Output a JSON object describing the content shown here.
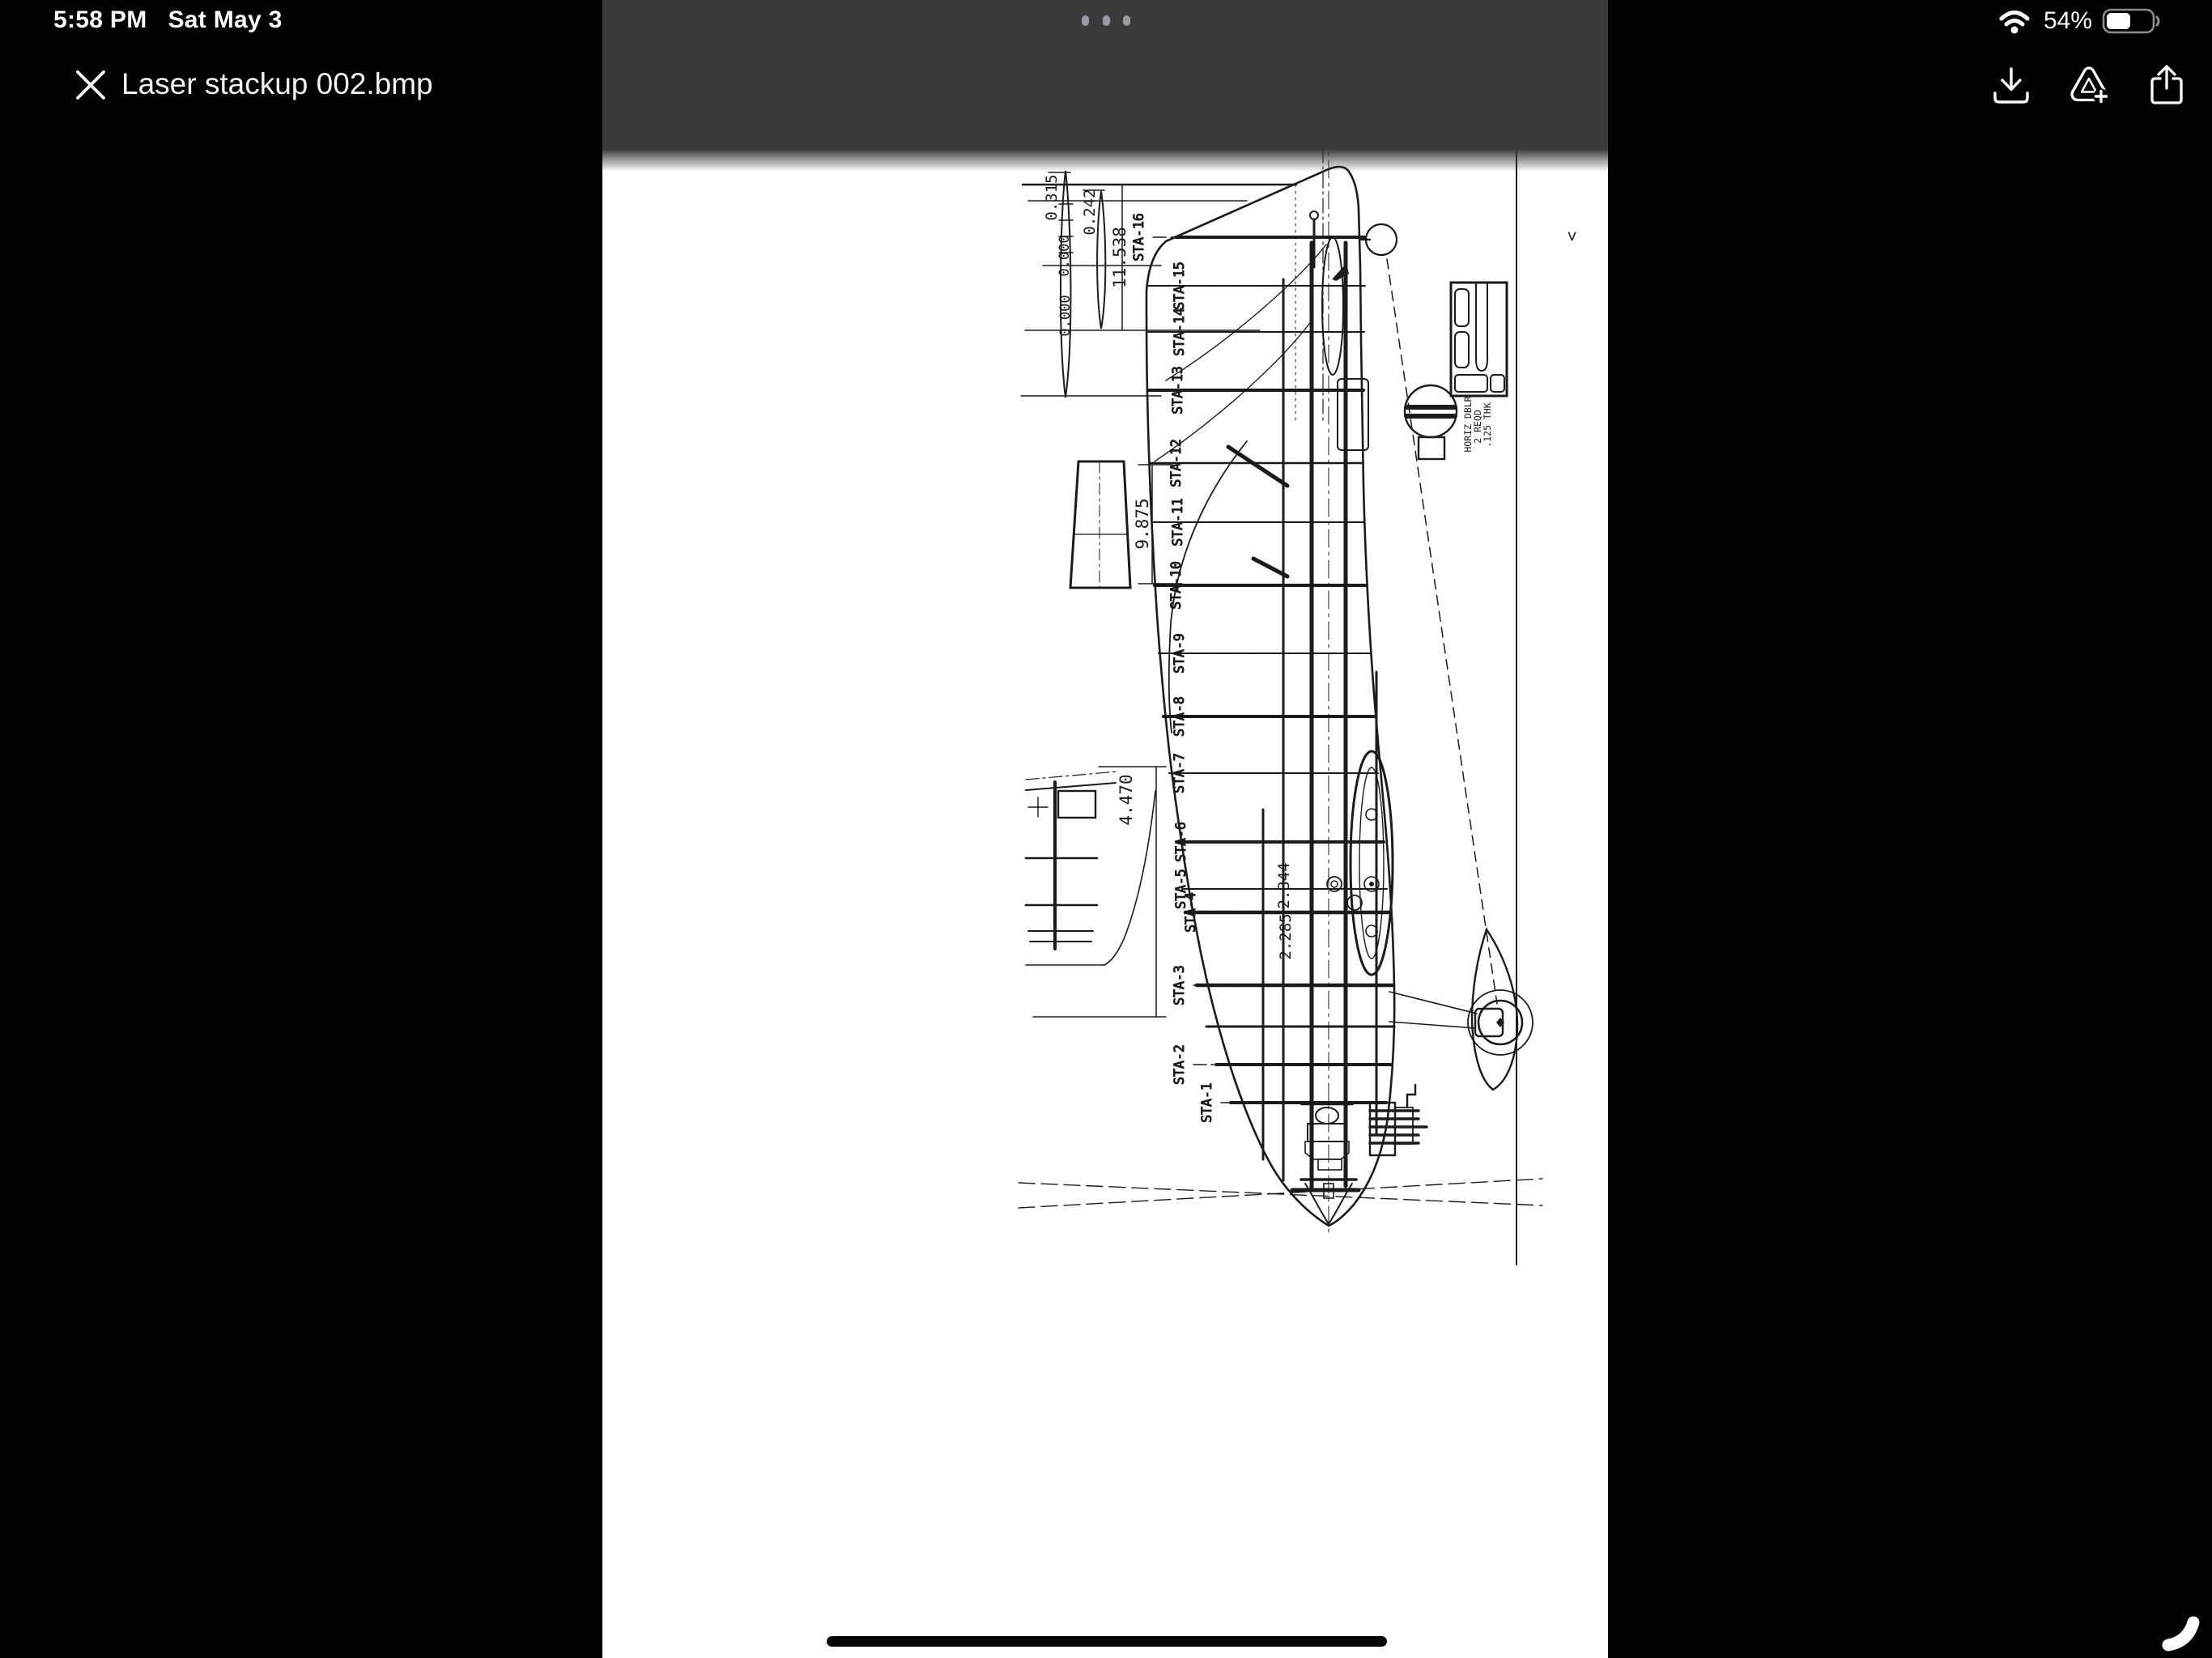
{
  "status_bar": {
    "time": "5:58 PM",
    "date": "Sat May 3",
    "battery_percent": "54%"
  },
  "viewer": {
    "title": "Laser stackup 002.bmp"
  },
  "blueprint": {
    "stations": [
      "STA-1",
      "STA-2",
      "STA-3",
      "STA-4",
      "STA-5",
      "STA-6",
      "STA-7",
      "STA-8",
      "STA-9",
      "STA-10",
      "STA-11",
      "STA-12",
      "STA-13",
      "STA-14",
      "STA-15",
      "STA-16"
    ],
    "dims": {
      "d0315": "0.315",
      "d0242": "0.242",
      "d0000a": "0.000",
      "d0000b": "0.000",
      "d11538": "11.538",
      "d9875": "9.875",
      "d4470": "4.470",
      "d2285": "2.285",
      "d2344": "2.344"
    },
    "note": {
      "line1": "HORIZ DBLR",
      "line2": "2 REQD",
      "line3": ".125 THK"
    },
    "sheet_mark": "<"
  }
}
